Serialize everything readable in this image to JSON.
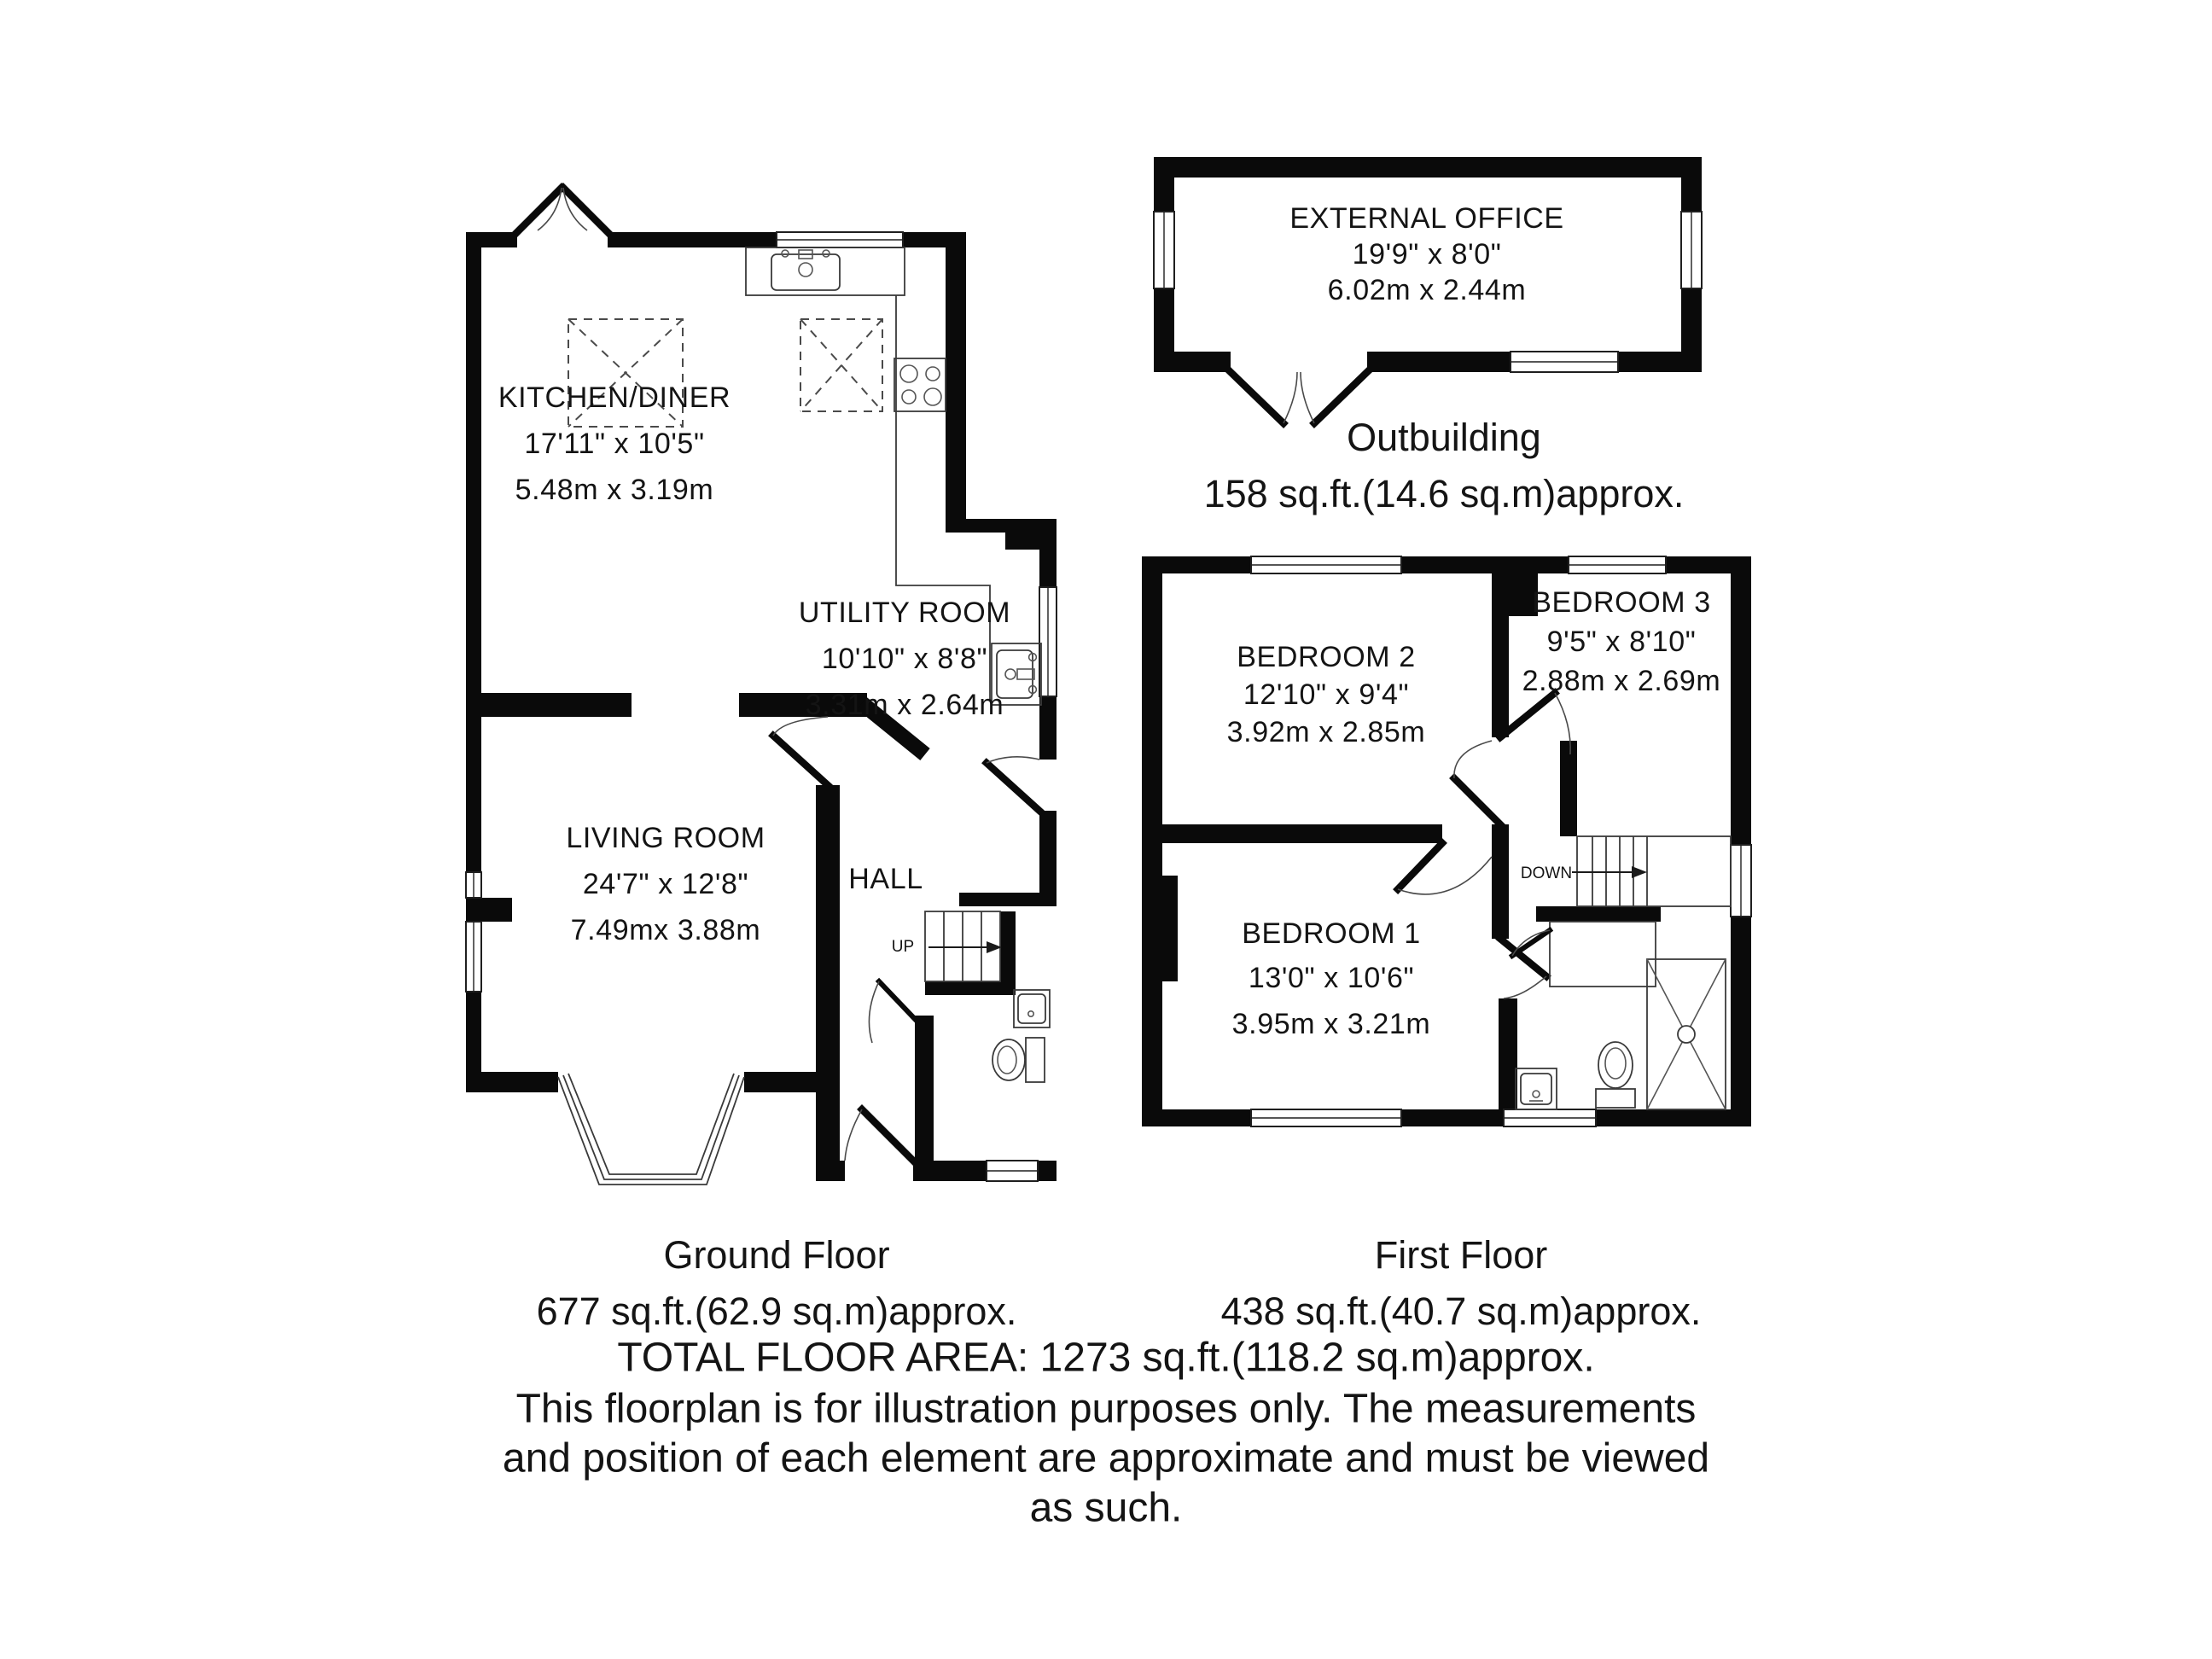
{
  "title": "Floorplan",
  "colors": {
    "wall": "#0a0a0a",
    "background": "#ffffff"
  },
  "rooms": {
    "kitchen": {
      "name": "KITCHEN/DINER",
      "imperial": "17'11\" x 10'5\"",
      "metric": "5.48m x 3.19m"
    },
    "utility": {
      "name": "UTILITY ROOM",
      "imperial": "10'10\" x 8'8\"",
      "metric": "3.31m x 2.64m"
    },
    "living": {
      "name": "LIVING ROOM",
      "imperial": "24'7\" x 12'8\"",
      "metric": "7.49mx 3.88m"
    },
    "hall": {
      "name": "HALL"
    },
    "office": {
      "name": "EXTERNAL OFFICE",
      "imperial": "19'9\" x 8'0\"",
      "metric": "6.02m x 2.44m"
    },
    "bedroom1": {
      "name": "BEDROOM 1",
      "imperial": "13'0\" x 10'6\"",
      "metric": "3.95m x 3.21m"
    },
    "bedroom2": {
      "name": "BEDROOM 2",
      "imperial": "12'10\" x 9'4\"",
      "metric": "3.92m x 2.85m"
    },
    "bedroom3": {
      "name": "BEDROOM 3",
      "imperial": "9'5\" x 8'10\"",
      "metric": "2.88m x 2.69m"
    }
  },
  "stairs": {
    "up": "UP",
    "down": "DOWN"
  },
  "floors": {
    "ground": {
      "label": "Ground Floor",
      "area": "677 sq.ft.(62.9 sq.m)approx."
    },
    "first": {
      "label": "First Floor",
      "area": "438 sq.ft.(40.7 sq.m)approx."
    },
    "outbuilding": {
      "label": "Outbuilding",
      "area": "158 sq.ft.(14.6 sq.m)approx."
    }
  },
  "footer": {
    "total": "TOTAL FLOOR AREA: 1273 sq.ft.(118.2 sq.m)approx.",
    "line2": "This floorplan is for illustration purposes only. The measurements",
    "line3": "and position of each element are approximate and must be viewed",
    "line4": "as such."
  }
}
